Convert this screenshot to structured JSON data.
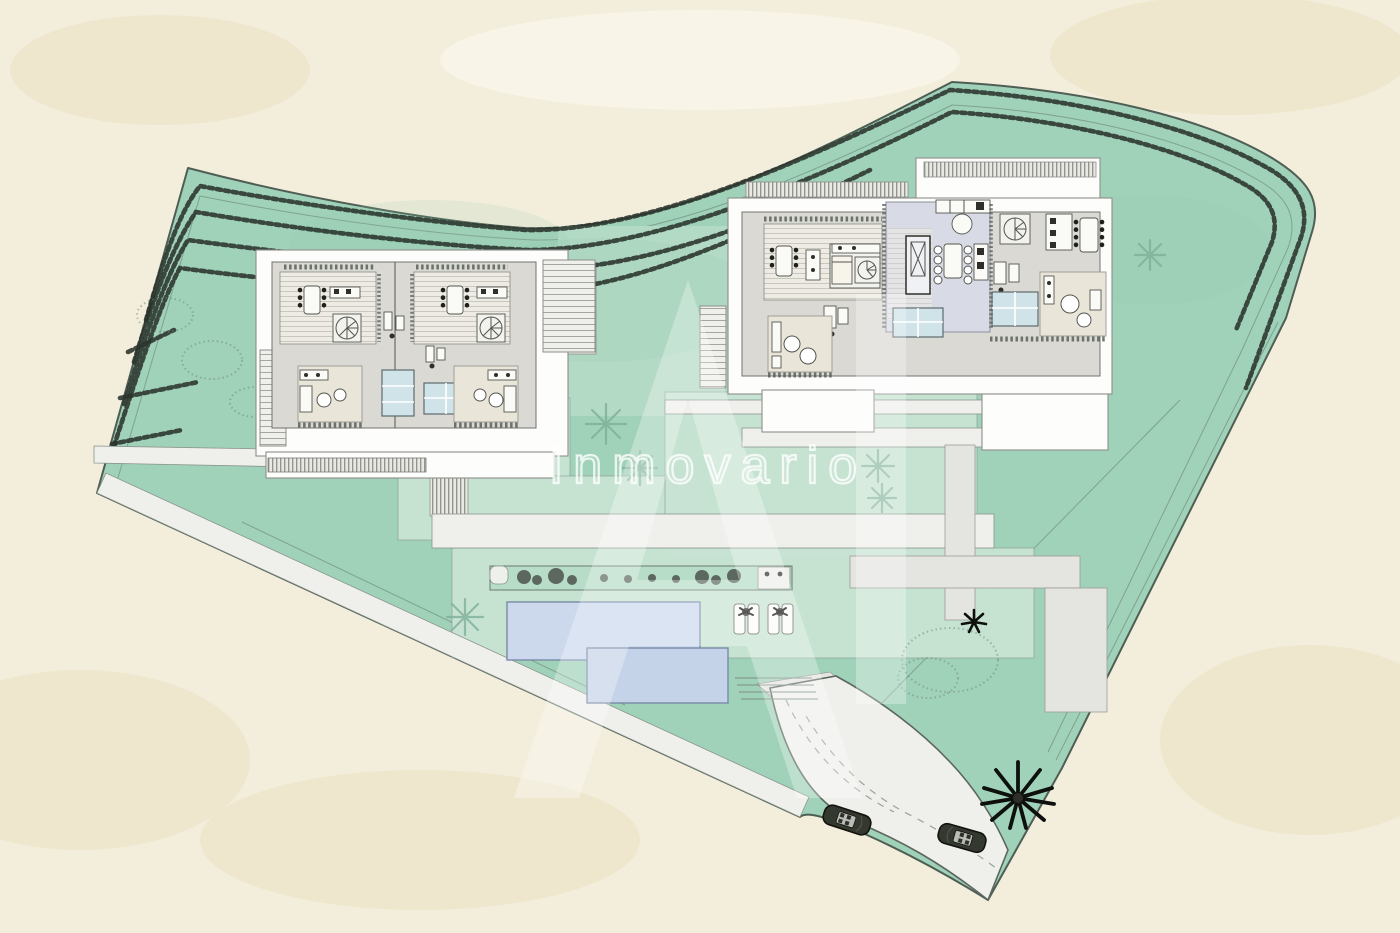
{
  "watermark": {
    "brand": "Inmovario",
    "monogram": "AI"
  },
  "site_plan": {
    "type": "architectural-site-plan",
    "features": {
      "villa_1": "semi-detached villa west",
      "villa_2": "semi-detached villa east",
      "pools": 2,
      "sun_loungers": 4,
      "cars": 2,
      "palm_tree": 1,
      "hedge_rows": "perimeter hedges along north and east boundary",
      "road": "access road along south-east boundary"
    }
  },
  "colors": {
    "background": "#f3eedb",
    "site_green": "#a0d2b9",
    "panel_green": "#c9e4d4",
    "lawn_green": "#b3dac4",
    "pool_blue": "#ccd9ec",
    "pool_blue2": "#c5d3e9",
    "path_white": "#eff0ec",
    "path_gray": "#e4e5e1",
    "road_gray": "#efefec",
    "building_white": "#fdfdfc",
    "roof_gray": "#dad9d4",
    "lavender": "#d8dbe5",
    "room_beige": "#e9e5d9",
    "glass_blue": "#cfe3e9",
    "hedge_dark": "#2a332c",
    "watermark_white": "#ffffff",
    "palm_black": "#0d100d",
    "tree_green": "#7fae99",
    "car_dark": "#34392f"
  }
}
